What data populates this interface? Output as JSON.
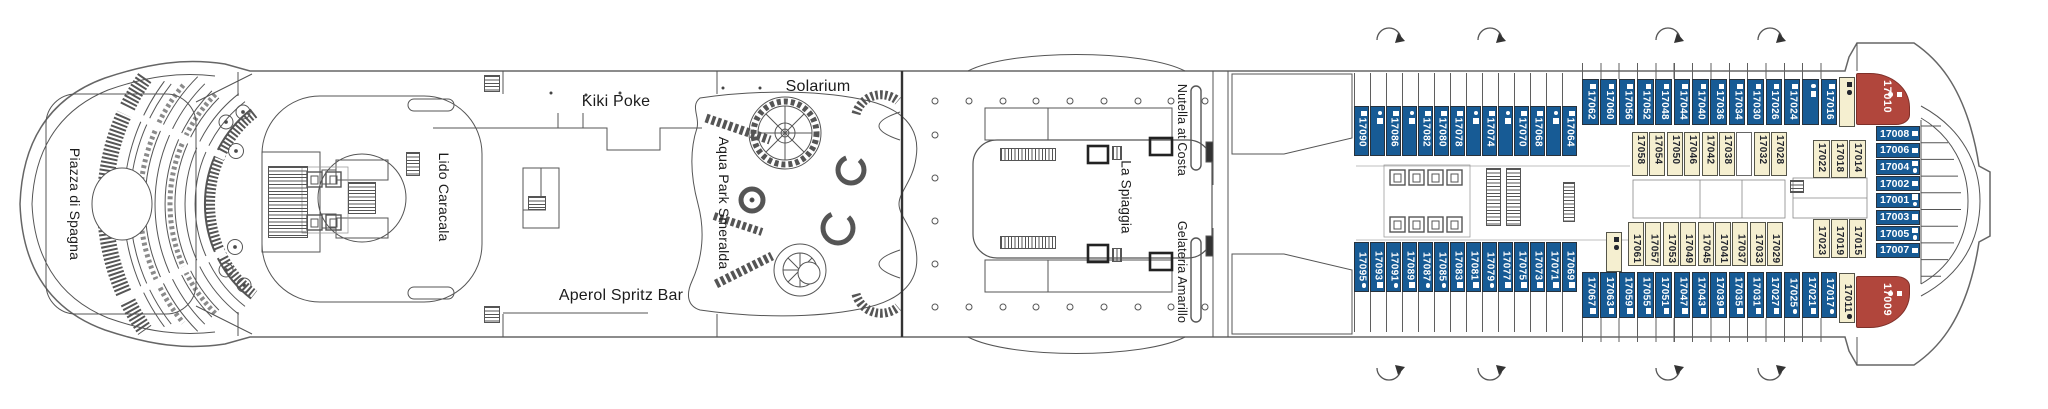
{
  "deck_plan": {
    "venues": {
      "piazza": "Piazza di Spagna",
      "lido": "Lido Caracala",
      "kiki": "Kiki Poke",
      "solarium": "Solarium",
      "aperol": "Aperol Spritz Bar",
      "aquapark": "Aqua Park Smeralda",
      "spiaggia": "La Spiaggia",
      "nutella": "Nutella at Costa",
      "gelateria": "Gelateria Amarillo"
    },
    "colors": {
      "cabin_blue": "#175b95",
      "cabin_cream": "#f5efd0",
      "cabin_red": "#b1463c",
      "line": "#555555"
    },
    "cabin_rows": [
      {
        "id": "top_outer_fwd",
        "cabins": [
          {
            "n": "17090",
            "sym": [
              "sq"
            ]
          },
          {
            "n": "17088",
            "sym": [
              "dot",
              "sq"
            ]
          },
          {
            "n": "17086",
            "sym": [
              "sq"
            ]
          },
          {
            "n": "17084",
            "sym": [
              "dot",
              "sq"
            ]
          },
          {
            "n": "17082",
            "sym": [
              "sq"
            ]
          },
          {
            "n": "17080",
            "sym": [
              "sq"
            ]
          },
          {
            "n": "17078",
            "sym": [
              "sq"
            ]
          },
          {
            "n": "17076",
            "sym": [
              "dot",
              "sq"
            ]
          },
          {
            "n": "17074",
            "sym": [
              "sq"
            ]
          },
          {
            "n": "17072",
            "sym": [
              "dot",
              "sq"
            ]
          },
          {
            "n": "17070",
            "sym": [
              "sq"
            ]
          },
          {
            "n": "17068",
            "sym": [
              "sq"
            ]
          },
          {
            "n": "17066",
            "sym": [
              "dot",
              "sq"
            ]
          },
          {
            "n": "17064",
            "sym": [
              "sq"
            ]
          }
        ]
      },
      {
        "id": "top_outer_aft",
        "cabins": [
          {
            "n": "17062",
            "sym": [
              "sq"
            ]
          },
          {
            "n": "17060",
            "sym": [
              "sq"
            ]
          },
          {
            "n": "17056",
            "sym": [
              "sq"
            ]
          },
          {
            "n": "17052",
            "sym": [
              "sq"
            ]
          },
          {
            "n": "17048",
            "sym": [
              "sq"
            ]
          },
          {
            "n": "17044",
            "sym": [
              "sq"
            ]
          },
          {
            "n": "17040",
            "sym": [
              "sq"
            ]
          },
          {
            "n": "17036",
            "sym": [
              "sq"
            ]
          },
          {
            "n": "17034",
            "sym": [
              "sq"
            ]
          },
          {
            "n": "17030",
            "sym": [
              "sq"
            ]
          },
          {
            "n": "17026",
            "sym": [
              "sq"
            ]
          },
          {
            "n": "17024",
            "sym": [
              "sq"
            ]
          },
          {
            "n": "17020",
            "sym": [
              "dot",
              "sq"
            ]
          },
          {
            "n": "17016",
            "sym": [
              "sq"
            ]
          }
        ]
      },
      {
        "id": "top_inner_aft",
        "cabins": [
          {
            "n": "17058",
            "sym": []
          },
          {
            "n": "17054",
            "sym": []
          },
          {
            "n": "17050",
            "sym": []
          },
          {
            "n": "17046",
            "sym": []
          },
          {
            "n": "17042",
            "sym": []
          },
          {
            "n": "17038",
            "sym": []
          },
          {
            "n": "",
            "sym": []
          },
          {
            "n": "17032",
            "sym": []
          },
          {
            "n": "17028",
            "sym": []
          }
        ]
      },
      {
        "id": "top_inner_stern",
        "cabins": [
          {
            "n": "17022",
            "sym": []
          },
          {
            "n": "17018",
            "sym": []
          },
          {
            "n": "17014",
            "sym": []
          }
        ]
      },
      {
        "id": "bottom_inner_aft",
        "cabins": [
          {
            "n": "17061",
            "sym": []
          },
          {
            "n": "17057",
            "sym": []
          },
          {
            "n": "17053",
            "sym": []
          },
          {
            "n": "17049",
            "sym": []
          },
          {
            "n": "17045",
            "sym": []
          },
          {
            "n": "17041",
            "sym": []
          },
          {
            "n": "17037",
            "sym": []
          },
          {
            "n": "17033",
            "sym": []
          },
          {
            "n": "17029",
            "sym": []
          }
        ]
      },
      {
        "id": "bottom_inner_stern",
        "cabins": [
          {
            "n": "17023",
            "sym": []
          },
          {
            "n": "17019",
            "sym": []
          },
          {
            "n": "17015",
            "sym": []
          }
        ]
      },
      {
        "id": "bottom_outer_fwd",
        "cabins": [
          {
            "n": "17095",
            "sym": [
              "dot",
              "sq"
            ]
          },
          {
            "n": "17093",
            "sym": [
              "sq"
            ]
          },
          {
            "n": "17091",
            "sym": [
              "dot",
              "sq"
            ]
          },
          {
            "n": "17089",
            "sym": [
              "sq"
            ]
          },
          {
            "n": "17087",
            "sym": [
              "dot",
              "sq"
            ]
          },
          {
            "n": "17085",
            "sym": [
              "dot",
              "sq"
            ]
          },
          {
            "n": "17083",
            "sym": [
              "sq"
            ]
          },
          {
            "n": "17081",
            "sym": [
              "sq"
            ]
          },
          {
            "n": "17079",
            "sym": [
              "dot",
              "sq"
            ]
          },
          {
            "n": "17077",
            "sym": [
              "sq"
            ]
          },
          {
            "n": "17075",
            "sym": [
              "sq"
            ]
          },
          {
            "n": "17073",
            "sym": [
              "sq"
            ]
          },
          {
            "n": "17071",
            "sym": [
              "sq"
            ]
          },
          {
            "n": "17069",
            "sym": [
              "sq"
            ]
          }
        ]
      },
      {
        "id": "bottom_outer_aft",
        "cabins": [
          {
            "n": "17067",
            "sym": [
              "sq"
            ]
          },
          {
            "n": "17063",
            "sym": [
              "sq"
            ]
          },
          {
            "n": "17059",
            "sym": [
              "sq"
            ]
          },
          {
            "n": "17055",
            "sym": [
              "sq"
            ]
          },
          {
            "n": "17051",
            "sym": [
              "sq"
            ]
          },
          {
            "n": "17047",
            "sym": [
              "sq"
            ]
          },
          {
            "n": "17043",
            "sym": [
              "sq"
            ]
          },
          {
            "n": "17039",
            "sym": [
              "sq"
            ]
          },
          {
            "n": "17035",
            "sym": [
              "sq"
            ]
          },
          {
            "n": "17031",
            "sym": [
              "sq"
            ]
          },
          {
            "n": "17027",
            "sym": [
              "sq"
            ]
          },
          {
            "n": "17025",
            "sym": [
              "dot",
              "sq"
            ]
          },
          {
            "n": "17021",
            "sym": [
              "sq"
            ]
          },
          {
            "n": "17017",
            "sym": [
              "dot",
              "sq"
            ]
          }
        ]
      },
      {
        "id": "single_17065",
        "cabins": [
          {
            "n": "17065",
            "sym": [
              "sq",
              "dot"
            ]
          }
        ]
      },
      {
        "id": "single_17012",
        "cabins": [
          {
            "n": "17012",
            "sym": [
              "sq",
              "dot"
            ]
          }
        ]
      },
      {
        "id": "single_17011",
        "cabins": [
          {
            "n": "17011",
            "sym": [
              "dot",
              "sq"
            ]
          }
        ]
      },
      {
        "id": "red_17010",
        "cabins": [
          {
            "n": "17010",
            "sym": [
              "sq",
              "dot"
            ]
          }
        ]
      },
      {
        "id": "red_17009",
        "cabins": [
          {
            "n": "17009",
            "sym": [
              "sq",
              "dot"
            ]
          }
        ]
      },
      {
        "id": "stern_rows",
        "cabins": [
          {
            "n": "17008",
            "sym": [
              "sq"
            ]
          },
          {
            "n": "17006",
            "sym": [
              "sq"
            ]
          },
          {
            "n": "17004",
            "sym": [
              "sq",
              "dot"
            ]
          },
          {
            "n": "17002",
            "sym": [
              "sq"
            ]
          },
          {
            "n": "17001",
            "sym": [
              "sq",
              "dot"
            ]
          },
          {
            "n": "17003",
            "sym": [
              "sq"
            ]
          },
          {
            "n": "17005",
            "sym": [
              "sq",
              "dot"
            ]
          },
          {
            "n": "17007",
            "sym": [
              "sq"
            ]
          }
        ]
      }
    ]
  }
}
